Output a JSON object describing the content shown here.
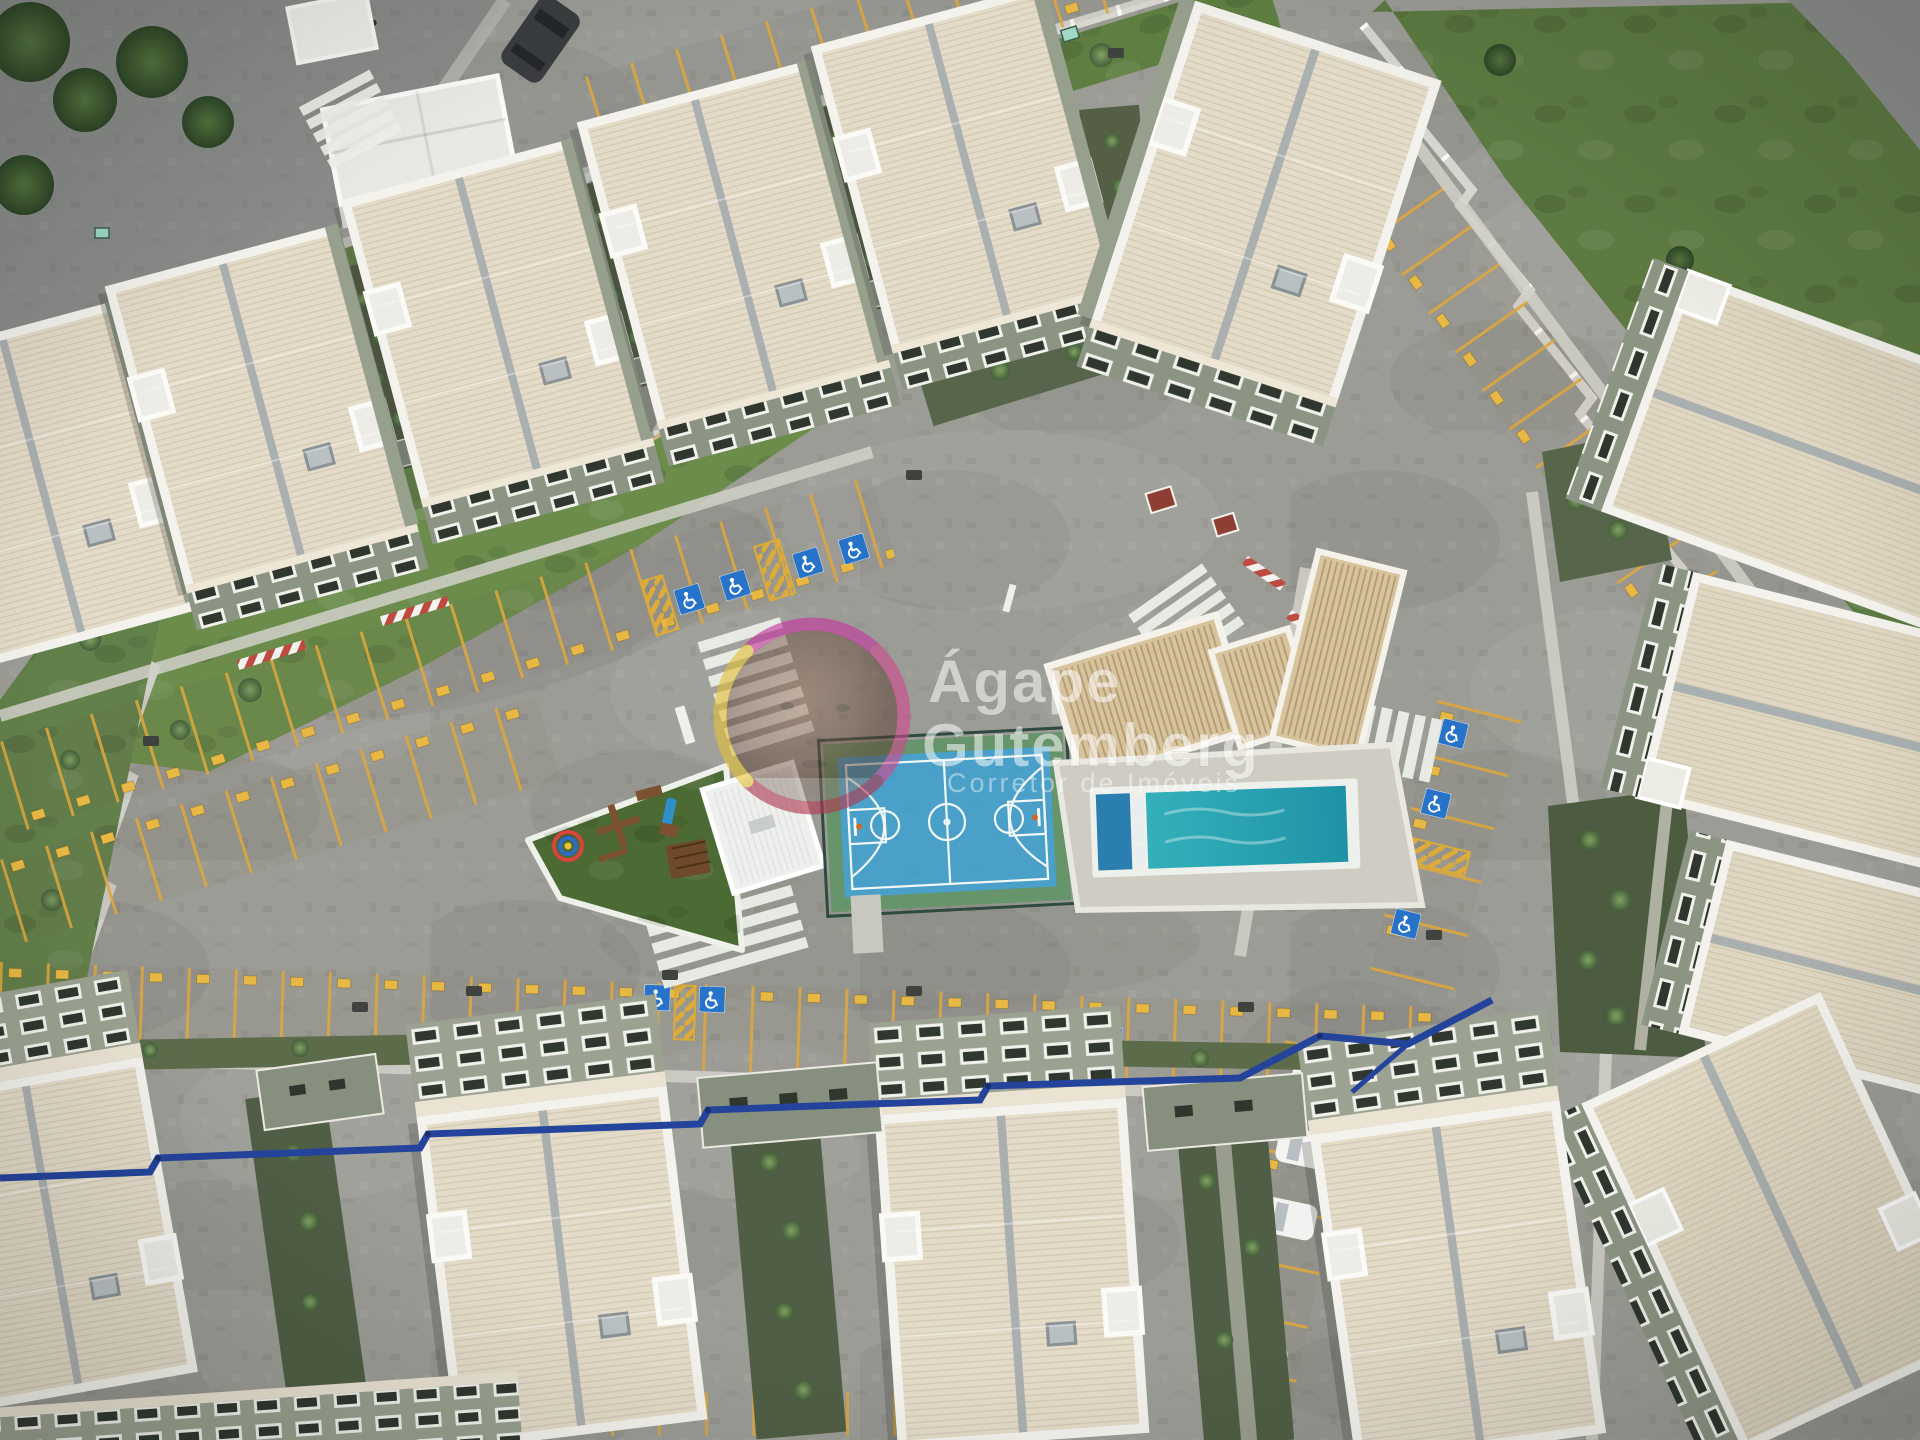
{
  "image": {
    "kind": "aerial-drone-photo",
    "subject": "residential condominium complex seen from directly above",
    "width_px": 1920,
    "height_px": 1440
  },
  "watermark": {
    "brand_line1": "Ágape",
    "brand_line2": "Gutemberg",
    "tagline": "Corretor de Imóveis",
    "text_color": "#ffffff",
    "logo": "circular portrait photo of a man inside a rainbow gradient ring",
    "ring_colors": [
      "#c636a0",
      "#d04b92",
      "#b03a52",
      "#e3c23a"
    ]
  },
  "scene": {
    "features": [
      "rows of apartment blocks with cream corrugated roofs",
      "grey cobblestone internal streets",
      "parking rows with yellow dividers and small numbered tags",
      "accessible parking spaces with blue wheelchair markings",
      "yellow hatched no-parking zones",
      "white zebra pedestrian crosswalks",
      "entrance gatehouse with curved driveway and lawn",
      "playground with wooden equipment, blue slide and color spinner",
      "blue basketball court with white markings and green border",
      "swimming pool with turquoise water and concrete deck",
      "clubhouse with ribbed tan roof",
      "perimeter wall with white posts",
      "courtyard gardens with round shrubs",
      "white parked cars and one dark car on the outside street",
      "dark blue utility pipe crossing the lower road"
    ],
    "palette": {
      "pavement": "#9c9c96",
      "asphalt_street": "#898b88",
      "roof_cream": "#e4dbc8",
      "roof_tan": "#d8c49c",
      "facade_green_grey": "#8c9483",
      "grass": "#6b8c4b",
      "court_blue": "#4aa0c8",
      "court_green": "#66946b",
      "pool_teal": "#2ba7b4",
      "parking_yellow": "#dca73e",
      "handicap_blue": "#2673c9",
      "pipe_blue": "#24449c"
    }
  }
}
